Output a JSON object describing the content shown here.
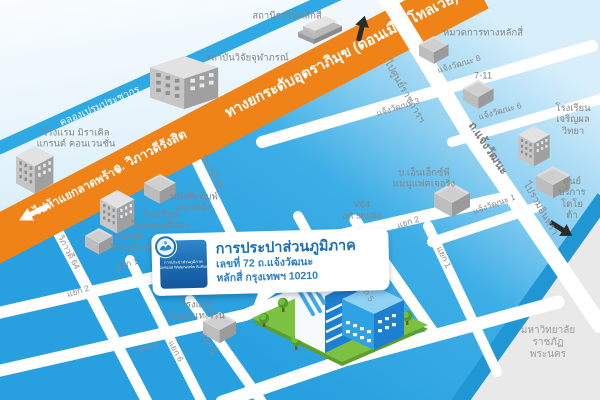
{
  "roads": {
    "canal": "คลองเปรมประชากร",
    "tollway": "ทางยกระดับอุตราภิมุข (ดอนเมืองโทลเวย์)",
    "vibhavadi": "ถ. วิภาวดีรังสิต",
    "to_ladprao": "ไปห้าแยกลาดพร้าว",
    "to_govt_complex": "ไปศูนย์ราชการฯ",
    "chaengwattana": "ถ.แจ้งวัฒนะ",
    "to_ramindra": "ไปรามอินทรา",
    "cw1": "แจ้งวัฒนะ 1",
    "cw3": "แจ้งวัฒนะ 3",
    "cw6": "แจ้งวัฒนะ 6",
    "cw8": "แจ้งวัฒนะ 8",
    "vb64": "วิภาวดี 64",
    "vb66": "วิภาวดี 66",
    "yaek1": "แยก 1",
    "yaek2": "แยก 2",
    "yaek4": "แยก 4",
    "yaek5": "แยก 5",
    "yaek6": "แยก 6",
    "yaek8": "แยก 8"
  },
  "places": {
    "railway_station": "สถานีรถไฟหลักสี่",
    "chulabhorn": "สถาบันวิจัยจุฬาภรณ์",
    "miracle_hotel": "โรงแรม มิราเคิล\nแกรนด์ คอนเวนชั่น",
    "highway_div": "หมวดการทางหลักสี่",
    "seven_eleven": "7-11",
    "charoenphon_school": "โรงเรียน\nเจริญผลวิทยา",
    "toyota": "ศูนย์บริการ\nโตโยต้า",
    "nxp": "บ.เอ็นเอ็กซ์พี\nแมนูแฟคเจอริ่ง",
    "naewna": "หนังสือพิมพ์\nแนวหน้า",
    "phatai_school": "โรงเรียน\nไผทอุดมศึกษา",
    "market": "ตลาด\nวิภาวดี-64",
    "v64_studio": "V64\nart studio",
    "louis_hotel": "โรงแรม\nหลุยส์แทเวิร์น",
    "university": "มหาวิทยาลัยราชภัฏ\nพระนคร"
  },
  "callout": {
    "title": "การประปาส่วนภูมิภาค",
    "address1": "เลขที่ 72 ถ.แจ้งวัฒนะ",
    "address2": "หลักสี่ กรุงเทพฯ 10210",
    "logo_line1": "การประปาส่วนภูมิภาค",
    "logo_line2": "Provincial Waterworks Authority"
  },
  "colors": {
    "tollway_orange": "#F08318",
    "water_blue": "#2EA7E3",
    "canal_blue": "#2FA9E4",
    "canal_dark": "#2196D4",
    "grass_green": "#7CC142",
    "brand_blue": "#1B75BC"
  }
}
